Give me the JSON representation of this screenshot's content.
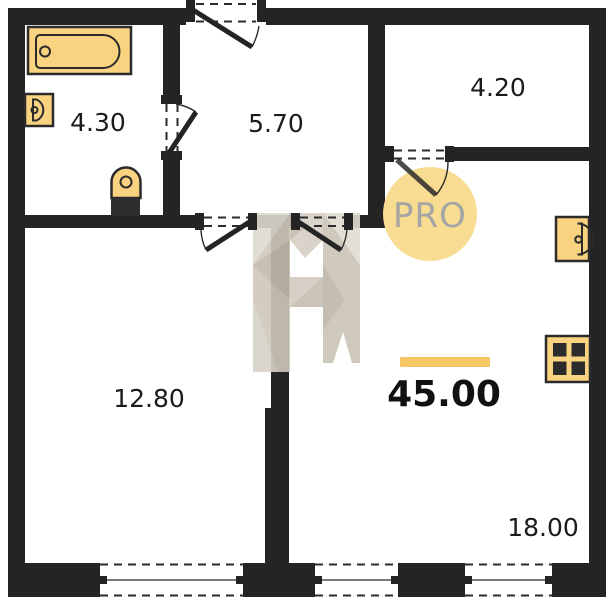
{
  "plan": {
    "total_area": "45.00",
    "badge_label": "PRO",
    "watermark_letter": "H",
    "rooms": [
      {
        "id": "bathroom",
        "area": "4.30"
      },
      {
        "id": "hallway",
        "area": "5.70"
      },
      {
        "id": "storage",
        "area": "4.20"
      },
      {
        "id": "living-room",
        "area": "12.80"
      },
      {
        "id": "kitchen-living",
        "area": "18.00"
      }
    ],
    "colors": {
      "wall": "#242424",
      "fixture_fill": "#F9D37F",
      "stove_fill": "#F3C45C",
      "accent_bar": "#F5C663",
      "badge_circle": "#F8DC92",
      "badge_text": "#A5A5A5",
      "label_text": "#1B1B1B",
      "watermark_beige": "#D2CCC0"
    }
  }
}
